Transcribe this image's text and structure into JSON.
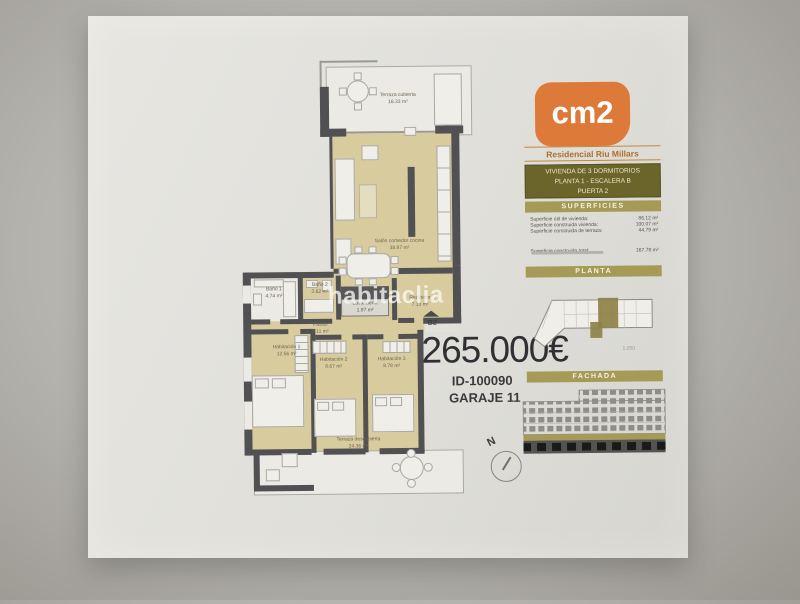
{
  "floor_plan": {
    "rooms": [
      {
        "name": "Terraza cubierta",
        "area": "16.33 m²"
      },
      {
        "name": "Salón comedor cocina",
        "area": "38.87 m²"
      },
      {
        "name": "Baño 1",
        "area": "4.74 m²"
      },
      {
        "name": "Baño 2",
        "area": "3.62 m²"
      },
      {
        "name": "Lavandería",
        "area": "1.97 m²"
      },
      {
        "name": "Recibidor",
        "area": "7.13 m²"
      },
      {
        "name": "Pasillo",
        "area": "5.11 m²"
      },
      {
        "name": "Habitación 1",
        "area": "12.56 m²"
      },
      {
        "name": "Habitación 2",
        "area": "8.67 m²"
      },
      {
        "name": "Habitación 3",
        "area": "8.78 m²"
      },
      {
        "name": "Terraza descubierta",
        "area": "24.36 m²"
      }
    ],
    "entrance_label": "B2",
    "compass_north": "N"
  },
  "listing": {
    "price": "265.000€",
    "property_id": "ID-100090",
    "garage": "GARAJE 11"
  },
  "watermark": {
    "text": "habitaclia"
  },
  "panel": {
    "logo_text": "cm2",
    "brand": "Residencial Riu Millars",
    "unit_lines": [
      "VIVIENDA DE 3 DORMITORIOS",
      "PLANTA 1 - ESCALERA B",
      "PUERTA 2"
    ],
    "superficies": {
      "title": "SUPERFICIES",
      "rows": [
        {
          "label": "Superficie útil de vivienda:",
          "value": "86.12 m²"
        },
        {
          "label": "Superficie construida vivienda:",
          "value": "100.07 m²"
        },
        {
          "label": "Superficie construida de terraza:",
          "value": "44.79 m²"
        }
      ],
      "total": {
        "label": "Superficie construida total:",
        "value": "167.78 m²"
      }
    },
    "planta_title": "PLANTA",
    "planta_scale": "1:250",
    "fachada_title": "FACHADA"
  },
  "colors": {
    "logo_orange": "#dd7a3a",
    "band_gold": "#a59b57",
    "box_olive": "#6b652c",
    "brand_text": "#b06f2c",
    "plan_beige": "#d8cc9e",
    "wall_dark": "#515154"
  }
}
